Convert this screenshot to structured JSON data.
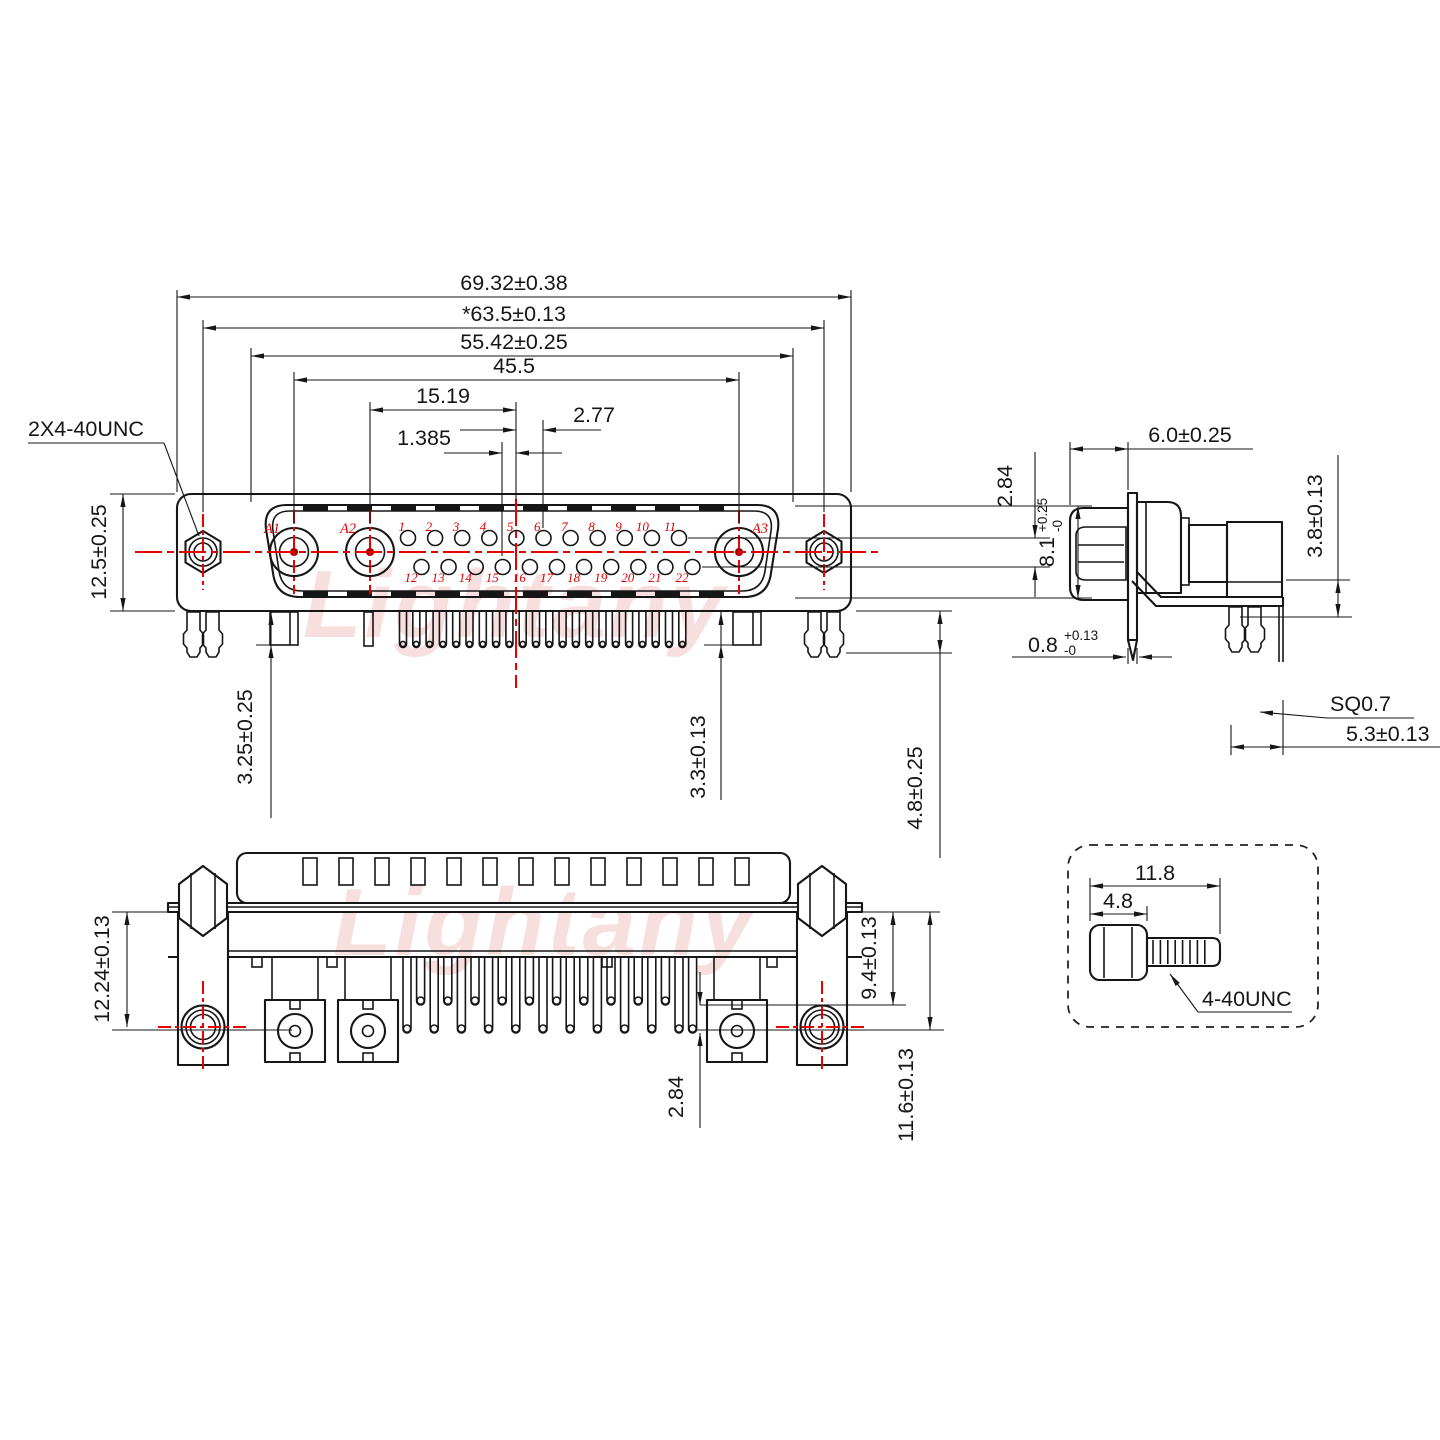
{
  "watermark": {
    "text": "Lightany"
  },
  "colors": {
    "line": "#161616",
    "accent_red": "#e90000",
    "watermark_pink": "#f2c6c6"
  },
  "front_view": {
    "label_thread": "2X4-40UNC",
    "coax_labels": [
      "A1",
      "A2",
      "A3"
    ],
    "pins_top": [
      "1",
      "2",
      "3",
      "4",
      "5",
      "6",
      "7",
      "8",
      "9",
      "10",
      "11"
    ],
    "pins_bottom": [
      "12",
      "13",
      "14",
      "15",
      "16",
      "17",
      "18",
      "19",
      "20",
      "21",
      "22"
    ],
    "dim_total_width": "69.32±0.38",
    "dim_mount_span": "*63.5±0.13",
    "dim_shell_width": "55.42±0.25",
    "dim_coax_span": "45.5",
    "dim_a2_to_center": "15.19",
    "dim_pin_pitch": "2.77",
    "dim_half_pitch": "1.385",
    "dim_flange_height": "12.5±0.25",
    "dim_leg_a1": "3.25±0.25",
    "dim_leg_a3": "3.3±0.13",
    "dim_row_offset": "2.84",
    "dim_slot_height": {
      "main": "8.1",
      "plus": "+0.25",
      "minus": "-0"
    },
    "dim_boardlock_len": "4.8±0.25"
  },
  "side_view": {
    "dim_front_depth": "6.0±0.25",
    "dim_bracket_drop": "3.8±0.13",
    "dim_flange_thickness": {
      "main": "0.8",
      "plus": "+0.13",
      "minus": "-0"
    },
    "label_pin_square": "SQ0.7",
    "dim_pin_offset": "5.3±0.13"
  },
  "bottom_view": {
    "dim_bracket_height": "12.24±0.13",
    "dim_short_pins": "9.4±0.13",
    "dim_long_pins": "11.6±0.13",
    "dim_row_offset": "2.84"
  },
  "screw_detail": {
    "dim_total_length": "11.8",
    "dim_head_length": "4.8",
    "label_thread": "4-40UNC"
  }
}
